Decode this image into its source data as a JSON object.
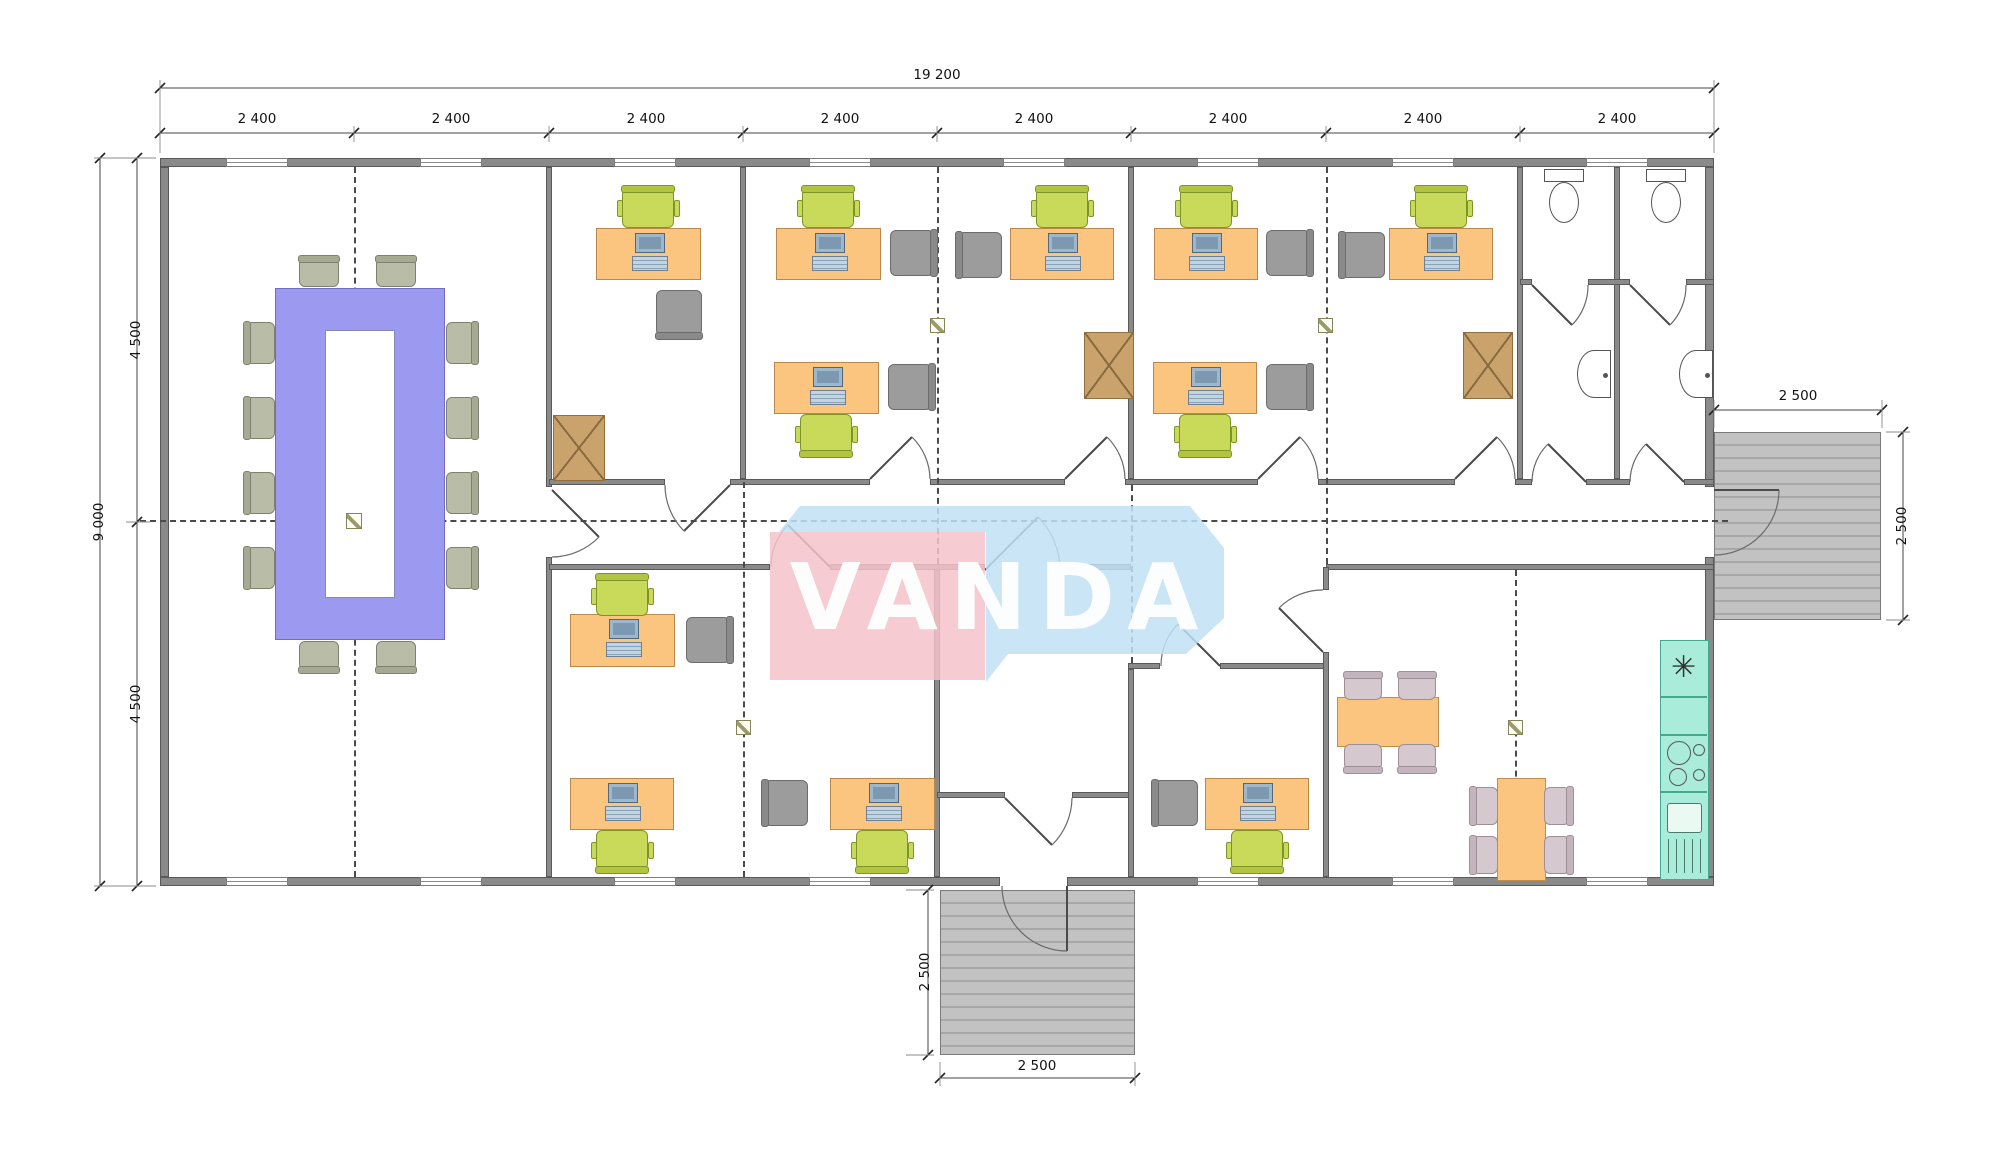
{
  "meta": {
    "drawing_type": "office-floor-plan"
  },
  "logo": {
    "text": "VANDA",
    "pink": "#f5c3ca",
    "blue": "#bfe0f4",
    "text_color": "#ffffff"
  },
  "colors": {
    "wall": "#8a8a8a",
    "desk": "#fbc580",
    "desk_border": "#b9884a",
    "office_chair": "#c9da5a",
    "visitor_chair": "#9c9c9c",
    "conference_table": "#9c9af0",
    "conference_chair": "#b9bda8",
    "break_chair": "#d5c8cf",
    "kitchen_counter": "#a9ecd9",
    "cabinet": "#c9a36b",
    "deck": "#bdbdbd",
    "dash": "#4a4a4a"
  },
  "dimensions": {
    "labels": [
      {
        "text": "19 200",
        "x": 937,
        "y": 75,
        "rot": 0,
        "name": "dim-total-width"
      },
      {
        "text": "2 400",
        "x": 257,
        "y": 119,
        "rot": 0,
        "name": "dim-bay-1"
      },
      {
        "text": "2 400",
        "x": 451,
        "y": 119,
        "rot": 0,
        "name": "dim-bay-2"
      },
      {
        "text": "2 400",
        "x": 646,
        "y": 119,
        "rot": 0,
        "name": "dim-bay-3"
      },
      {
        "text": "2 400",
        "x": 840,
        "y": 119,
        "rot": 0,
        "name": "dim-bay-4"
      },
      {
        "text": "2 400",
        "x": 1034,
        "y": 119,
        "rot": 0,
        "name": "dim-bay-5"
      },
      {
        "text": "2 400",
        "x": 1228,
        "y": 119,
        "rot": 0,
        "name": "dim-bay-6"
      },
      {
        "text": "2 400",
        "x": 1423,
        "y": 119,
        "rot": 0,
        "name": "dim-bay-7"
      },
      {
        "text": "2 400",
        "x": 1617,
        "y": 119,
        "rot": 0,
        "name": "dim-bay-8"
      },
      {
        "text": "9 000",
        "x": 99,
        "y": 522,
        "rot": 1,
        "name": "dim-total-depth"
      },
      {
        "text": "4 500",
        "x": 136,
        "y": 340,
        "rot": 1,
        "name": "dim-depth-upper"
      },
      {
        "text": "4 500",
        "x": 136,
        "y": 704,
        "rot": 1,
        "name": "dim-depth-lower"
      },
      {
        "text": "2 500",
        "x": 1798,
        "y": 396,
        "rot": 0,
        "name": "dim-right-deck-width"
      },
      {
        "text": "2 500",
        "x": 1902,
        "y": 526,
        "rot": 1,
        "name": "dim-right-deck-depth"
      },
      {
        "text": "2 500",
        "x": 925,
        "y": 972,
        "rot": 1,
        "name": "dim-bottom-deck-depth"
      },
      {
        "text": "2 500",
        "x": 1037,
        "y": 1066,
        "rot": 0,
        "name": "dim-bottom-deck-width"
      }
    ],
    "lines": [
      {
        "x1": 160,
        "y1": 88,
        "x2": 1714,
        "y2": 88,
        "ticks": [
          [
            160,
            88
          ],
          [
            1714,
            88
          ]
        ]
      },
      {
        "x1": 160,
        "y1": 133,
        "x2": 1714,
        "y2": 133,
        "ticks": [
          [
            160,
            133
          ],
          [
            354,
            133
          ],
          [
            549,
            133
          ],
          [
            743,
            133
          ],
          [
            937,
            133
          ],
          [
            1131,
            133
          ],
          [
            1326,
            133
          ],
          [
            1520,
            133
          ],
          [
            1714,
            133
          ]
        ]
      },
      {
        "x1": 100,
        "y1": 158,
        "x2": 100,
        "y2": 886,
        "ticks": [
          [
            100,
            158
          ],
          [
            100,
            886
          ]
        ]
      },
      {
        "x1": 137,
        "y1": 158,
        "x2": 137,
        "y2": 886,
        "ticks": [
          [
            137,
            158
          ],
          [
            137,
            522
          ],
          [
            137,
            886
          ]
        ]
      },
      {
        "x1": 1714,
        "y1": 410,
        "x2": 1882,
        "y2": 410,
        "ticks": [
          [
            1714,
            410
          ],
          [
            1882,
            410
          ]
        ]
      },
      {
        "x1": 1903,
        "y1": 432,
        "x2": 1903,
        "y2": 620,
        "ticks": [
          [
            1903,
            432
          ],
          [
            1903,
            620
          ]
        ]
      },
      {
        "x1": 928,
        "y1": 890,
        "x2": 928,
        "y2": 1055,
        "ticks": [
          [
            928,
            890
          ],
          [
            928,
            1055
          ]
        ]
      },
      {
        "x1": 940,
        "y1": 1078,
        "x2": 1135,
        "y2": 1078,
        "ticks": [
          [
            940,
            1078
          ],
          [
            1135,
            1078
          ]
        ]
      }
    ],
    "ext_lines": [
      [
        160,
        80,
        160,
        153
      ],
      [
        1714,
        80,
        1714,
        153
      ],
      [
        354,
        126,
        354,
        142
      ],
      [
        549,
        126,
        549,
        142
      ],
      [
        743,
        126,
        743,
        142
      ],
      [
        937,
        126,
        937,
        142
      ],
      [
        1131,
        126,
        1131,
        142
      ],
      [
        1326,
        126,
        1326,
        142
      ],
      [
        1520,
        126,
        1520,
        142
      ],
      [
        94,
        158,
        156,
        158
      ],
      [
        94,
        886,
        156,
        886
      ],
      [
        126,
        522,
        150,
        522
      ],
      [
        1714,
        400,
        1714,
        428
      ],
      [
        1882,
        400,
        1882,
        428
      ],
      [
        1886,
        432,
        1910,
        432
      ],
      [
        1886,
        620,
        1910,
        620
      ],
      [
        906,
        890,
        934,
        890
      ],
      [
        906,
        1055,
        934,
        1055
      ],
      [
        940,
        1062,
        940,
        1086
      ],
      [
        1135,
        1062,
        1135,
        1086
      ]
    ]
  },
  "plan": {
    "walls": [
      [
        160,
        158,
        1554,
        9
      ],
      [
        160,
        877,
        840,
        9
      ],
      [
        1067,
        877,
        647,
        9
      ],
      [
        160,
        167,
        9,
        710
      ],
      [
        1705,
        167,
        9,
        320
      ],
      [
        1705,
        557,
        9,
        320
      ],
      [
        546,
        167,
        6,
        320
      ],
      [
        546,
        557,
        6,
        320
      ],
      [
        740,
        167,
        6,
        312
      ],
      [
        1128,
        167,
        6,
        312
      ],
      [
        1517,
        167,
        6,
        312
      ],
      [
        1614,
        167,
        6,
        312
      ],
      [
        1520,
        279,
        12,
        6
      ],
      [
        1588,
        279,
        42,
        6
      ],
      [
        1686,
        279,
        28,
        6
      ],
      [
        549,
        479,
        116,
        6
      ],
      [
        730,
        479,
        140,
        6
      ],
      [
        930,
        479,
        135,
        6
      ],
      [
        1125,
        479,
        133,
        6
      ],
      [
        1318,
        479,
        137,
        6
      ],
      [
        1515,
        479,
        17,
        6
      ],
      [
        1586,
        479,
        44,
        6
      ],
      [
        1684,
        479,
        30,
        6
      ],
      [
        549,
        564,
        221,
        6
      ],
      [
        830,
        564,
        155,
        6
      ],
      [
        1060,
        564,
        71,
        6
      ],
      [
        1326,
        564,
        388,
        6
      ],
      [
        934,
        570,
        6,
        307
      ],
      [
        937,
        792,
        68,
        6
      ],
      [
        1072,
        792,
        59,
        6
      ],
      [
        1128,
        663,
        32,
        6
      ],
      [
        1220,
        663,
        106,
        6
      ],
      [
        1128,
        669,
        6,
        208
      ],
      [
        1323,
        567,
        6,
        23
      ],
      [
        1323,
        652,
        6,
        225
      ]
    ],
    "windows_top": [
      226,
      420,
      614,
      809,
      1003,
      1197,
      1392,
      1586
    ],
    "windows_bottom": [
      226,
      420,
      614,
      809,
      1197,
      1392,
      1586
    ],
    "window_w": 62,
    "decks": [
      [
        1714,
        432,
        167,
        188
      ],
      [
        940,
        890,
        195,
        165
      ]
    ],
    "dashes_h": [
      [
        140,
        520,
        1588
      ]
    ],
    "dashes_v": [
      [
        354,
        167,
        710
      ],
      [
        743,
        482,
        395
      ],
      [
        937,
        167,
        397
      ],
      [
        1131,
        485,
        178
      ],
      [
        1326,
        167,
        397
      ],
      [
        1515,
        570,
        307
      ]
    ],
    "doors": [
      {
        "leaf": "M552,490 L599,537",
        "arc": "M599,537 A67,67 0 0 1 552,557"
      },
      {
        "leaf": "M730,485 L684,531",
        "arc": "M684,531 A65,65 0 0 1 665,485"
      },
      {
        "leaf": "M870,479 L912,437",
        "arc": "M912,437 A60,60 0 0 1 930,479"
      },
      {
        "leaf": "M1065,479 L1107,437",
        "arc": "M1107,437 A60,60 0 0 1 1125,479"
      },
      {
        "leaf": "M1258,479 L1300,437",
        "arc": "M1300,437 A60,60 0 0 1 1318,479"
      },
      {
        "leaf": "M1455,479 L1497,437",
        "arc": "M1497,437 A60,60 0 0 1 1515,479"
      },
      {
        "leaf": "M1586,482 L1548,444",
        "arc": "M1548,444 A54,54 0 0 0 1532,482"
      },
      {
        "leaf": "M1684,482 L1646,444",
        "arc": "M1646,444 A54,54 0 0 0 1630,482"
      },
      {
        "leaf": "M1532,285 L1572,325",
        "arc": "M1572,325 A56,56 0 0 0 1588,285"
      },
      {
        "leaf": "M1630,285 L1670,325",
        "arc": "M1670,325 A56,56 0 0 0 1686,285"
      },
      {
        "leaf": "M830,567 L788,525",
        "arc": "M788,525 A59,59 0 0 0 771,567"
      },
      {
        "leaf": "M985,570 L1038,517",
        "arc": "M1038,517 A75,75 0 0 1 1060,570"
      },
      {
        "leaf": "M1005,798 L1052,845",
        "arc": "M1052,845 A67,67 0 0 0 1072,798"
      },
      {
        "leaf": "M1220,666 L1178,624",
        "arc": "M1178,624 A59,59 0 0 0 1161,666"
      },
      {
        "leaf": "M1323,652 L1279,608",
        "arc": "M1279,608 A62,62 0 0 1 1323,590"
      },
      {
        "leaf": "M1714,490 L1779,490",
        "arc": "M1779,490 A65,65 0 0 1 1714,555"
      },
      {
        "leaf": "M1067,886 L1067,951",
        "arc": "M1067,951 A65,65 0 0 1 1002,886"
      }
    ],
    "conference": {
      "table": [
        275,
        288,
        170,
        352
      ],
      "inner": [
        325,
        330,
        70,
        268
      ],
      "chairs": [
        [
          299,
          258,
          40,
          29,
          "S"
        ],
        [
          376,
          258,
          40,
          29,
          "S"
        ],
        [
          299,
          641,
          40,
          29,
          "N"
        ],
        [
          376,
          641,
          40,
          29,
          "N"
        ],
        [
          246,
          322,
          29,
          42,
          "E"
        ],
        [
          246,
          397,
          29,
          42,
          "E"
        ],
        [
          246,
          472,
          29,
          42,
          "E"
        ],
        [
          246,
          547,
          29,
          42,
          "E"
        ],
        [
          446,
          322,
          29,
          42,
          "W"
        ],
        [
          446,
          397,
          29,
          42,
          "W"
        ],
        [
          446,
          472,
          29,
          42,
          "W"
        ],
        [
          446,
          547,
          29,
          42,
          "W"
        ]
      ]
    },
    "desks": [
      [
        596,
        228,
        105,
        52
      ],
      [
        776,
        228,
        105,
        52
      ],
      [
        774,
        362,
        105,
        52
      ],
      [
        1010,
        228,
        104,
        52
      ],
      [
        1154,
        228,
        104,
        52
      ],
      [
        1153,
        362,
        104,
        52
      ],
      [
        1389,
        228,
        104,
        52
      ],
      [
        570,
        614,
        105,
        53
      ],
      [
        570,
        778,
        104,
        52
      ],
      [
        830,
        778,
        105,
        52
      ],
      [
        1205,
        778,
        104,
        52
      ]
    ],
    "office_chairs": [
      [
        622,
        188,
        52,
        40,
        "S"
      ],
      [
        802,
        188,
        52,
        40,
        "S"
      ],
      [
        800,
        414,
        52,
        40,
        "N"
      ],
      [
        1036,
        188,
        52,
        40,
        "S"
      ],
      [
        1180,
        188,
        52,
        40,
        "S"
      ],
      [
        1179,
        414,
        52,
        40,
        "N"
      ],
      [
        1415,
        188,
        52,
        40,
        "S"
      ],
      [
        596,
        576,
        52,
        40,
        "S"
      ],
      [
        596,
        830,
        52,
        40,
        "N"
      ],
      [
        856,
        830,
        52,
        40,
        "N"
      ],
      [
        1231,
        830,
        52,
        40,
        "N"
      ]
    ],
    "visitor_chairs": [
      [
        656,
        290,
        46,
        46,
        "N"
      ],
      [
        890,
        230,
        44,
        46,
        "W"
      ],
      [
        888,
        364,
        44,
        46,
        "W"
      ],
      [
        958,
        232,
        44,
        46,
        "E"
      ],
      [
        1266,
        230,
        44,
        46,
        "W"
      ],
      [
        1266,
        364,
        44,
        46,
        "W"
      ],
      [
        1341,
        232,
        44,
        46,
        "E"
      ],
      [
        686,
        617,
        44,
        46,
        "W"
      ],
      [
        764,
        780,
        44,
        46,
        "E"
      ],
      [
        1154,
        780,
        44,
        46,
        "E"
      ]
    ],
    "cabinets": [
      [
        553,
        415,
        52,
        66
      ],
      [
        1084,
        332,
        50,
        67
      ],
      [
        1463,
        332,
        50,
        67
      ]
    ],
    "break_tables": [
      [
        1337,
        697,
        102,
        50
      ],
      [
        1497,
        778,
        49,
        103
      ]
    ],
    "break_chairs": [
      [
        1344,
        674,
        38,
        26,
        "S"
      ],
      [
        1398,
        674,
        38,
        26,
        "S"
      ],
      [
        1344,
        744,
        38,
        26,
        "N"
      ],
      [
        1398,
        744,
        38,
        26,
        "N"
      ],
      [
        1472,
        787,
        26,
        38,
        "E"
      ],
      [
        1472,
        836,
        26,
        38,
        "E"
      ],
      [
        1544,
        787,
        26,
        38,
        "W"
      ],
      [
        1544,
        836,
        26,
        38,
        "W"
      ]
    ],
    "kitchen_counter": [
      1660,
      640,
      49,
      240
    ],
    "kitchen_sink_symbol": "✳",
    "markers": [
      [
        346,
        513,
        16,
        16
      ],
      [
        930,
        318,
        15,
        15
      ],
      [
        1318,
        318,
        15,
        15
      ],
      [
        736,
        720,
        15,
        15
      ],
      [
        1508,
        720,
        15,
        15
      ]
    ],
    "toilets": [
      [
        1544,
        169,
        40,
        54
      ],
      [
        1646,
        169,
        40,
        54
      ]
    ],
    "washbasins": [
      [
        1577,
        350,
        34,
        48
      ],
      [
        1679,
        350,
        34,
        48
      ]
    ]
  }
}
